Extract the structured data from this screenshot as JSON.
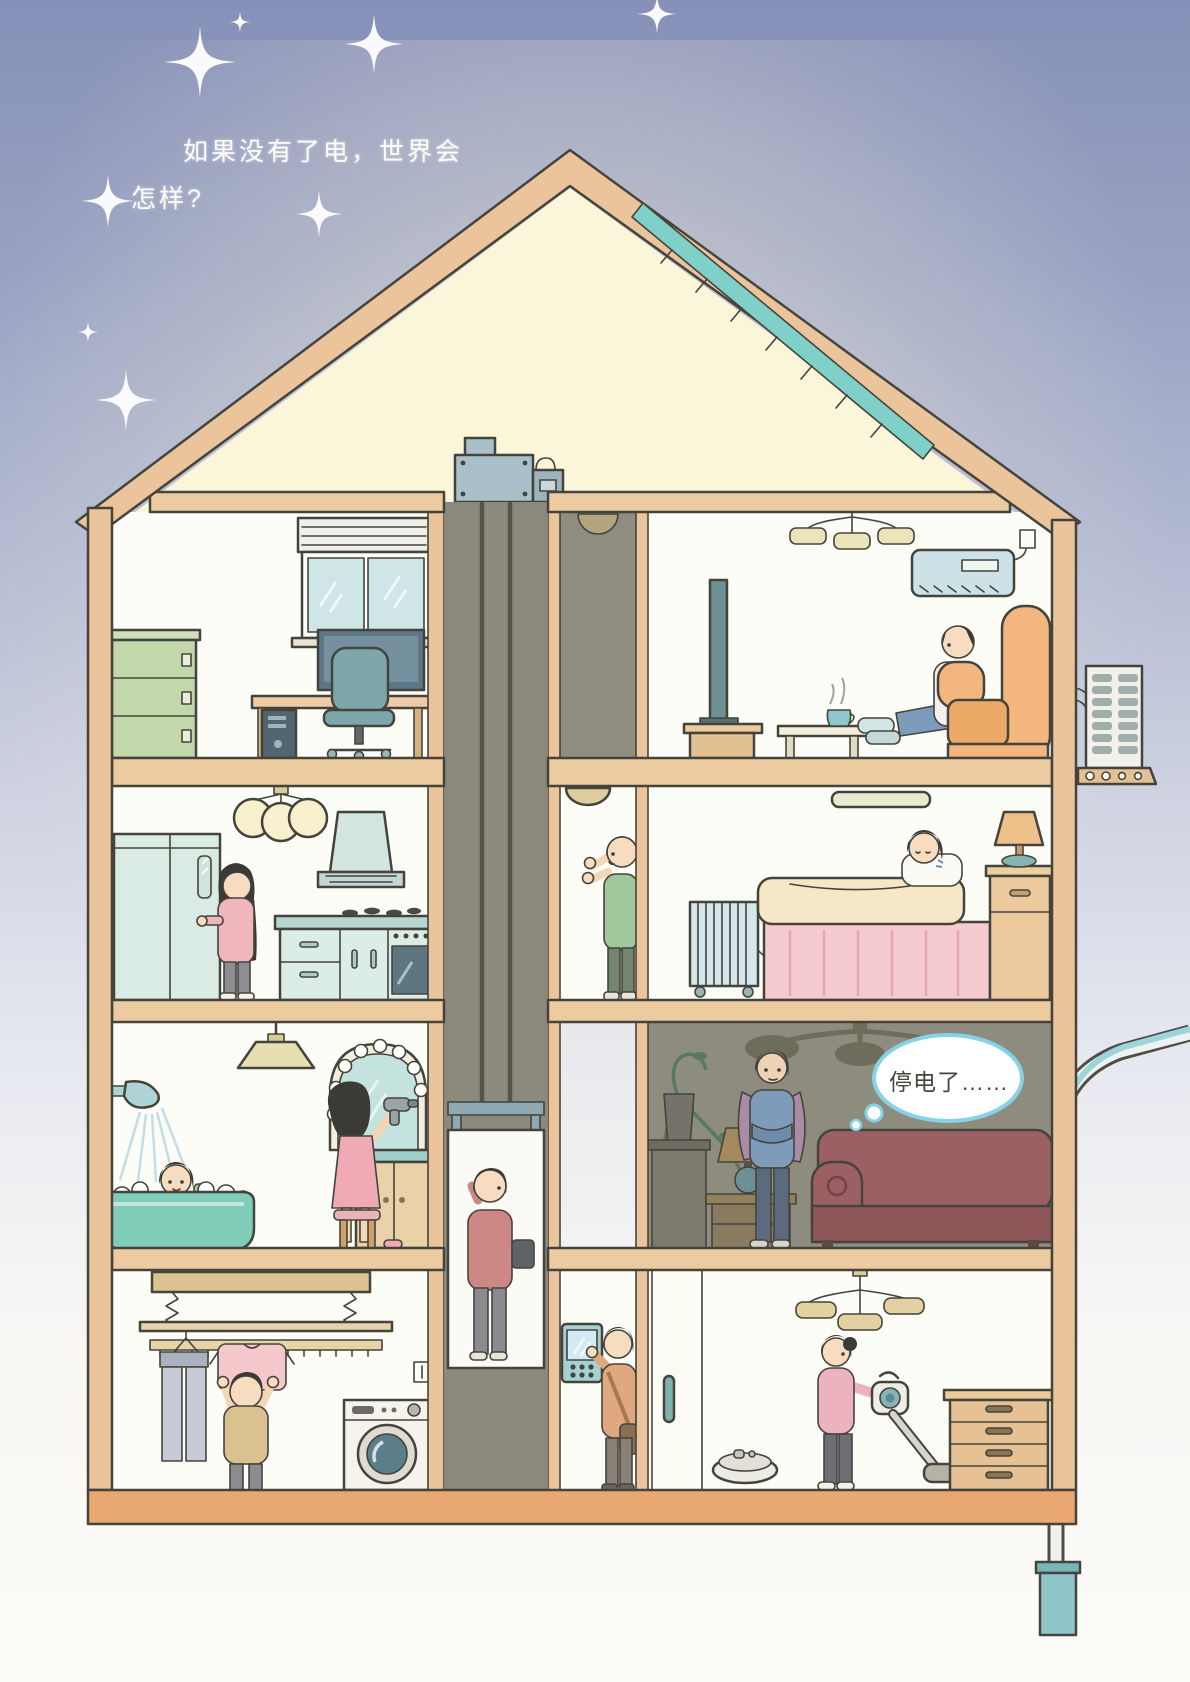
{
  "texts": {
    "caption_line1": "如果没有了电，世界会",
    "caption_line2": "怎样?",
    "thought_bubble": "停电了……"
  },
  "colors": {
    "sky_top": "#8790b8",
    "sky_bottom": "#fdfcf9",
    "house_wood": "#ecc49c",
    "outline": "#45443c",
    "attic_glow": "#fbf6da",
    "room_white": "#fdfdf8",
    "dark_room": "#8e8c7e",
    "elevator_shaft": "#8b897c",
    "foundation": "#e9a771",
    "thought_bubble_border": "#86d2e6",
    "solar_panel": "#7fd0c8",
    "sofa_red": "#9c6064",
    "accent_pink": "#f6cbd0",
    "accent_teal": "#7fb2ae"
  }
}
